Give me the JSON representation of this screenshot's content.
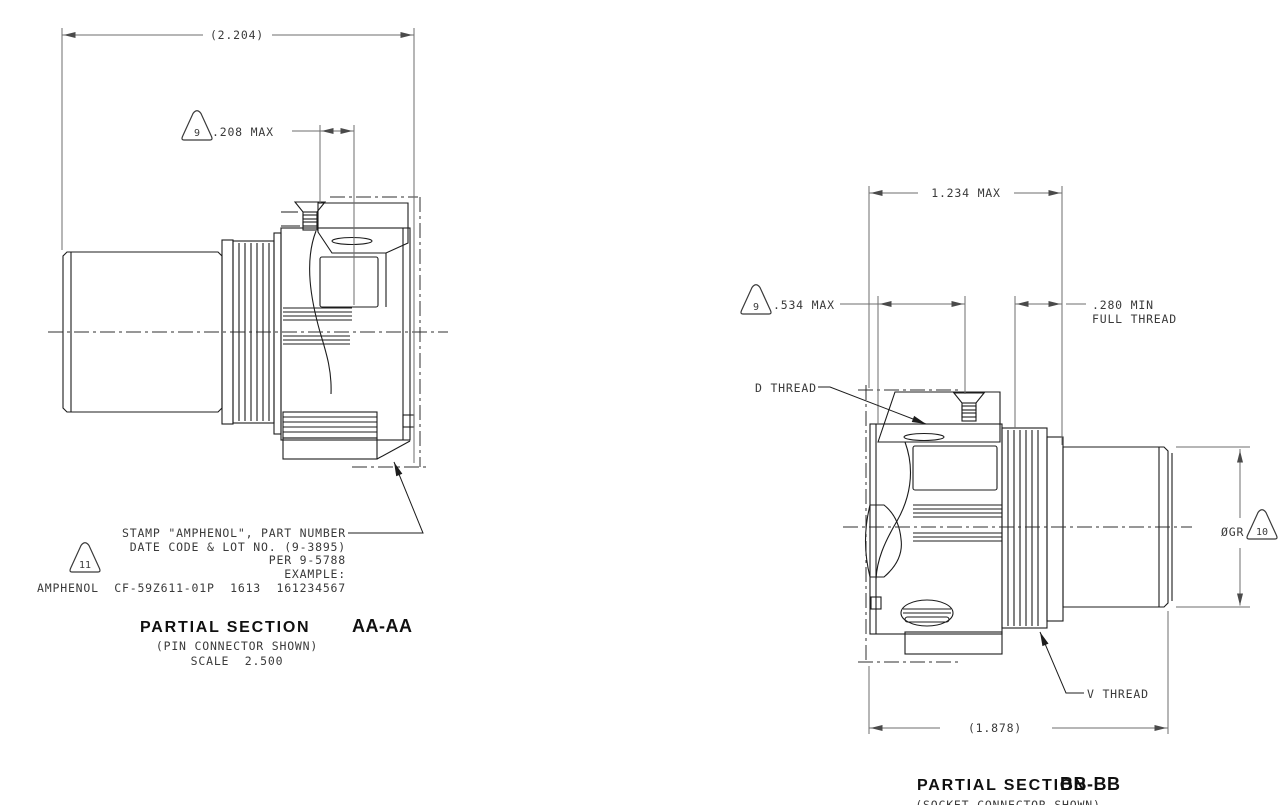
{
  "drawing": {
    "colors": {
      "part_line": "#1c1c1c",
      "dim_line": "#6e6e6e",
      "text": "#3a3a3a",
      "background": "#ffffff"
    },
    "aa": {
      "dim_overall": "(2.204)",
      "flag_208": "9",
      "dim_208": ".208 MAX",
      "note_flag": "11",
      "note_lines": [
        "STAMP \"AMPHENOL\", PART NUMBER",
        "DATE CODE & LOT NO. (9-3895)",
        "PER 9-5788",
        "EXAMPLE:",
        "AMPHENOL  CF-59Z611-01P  1613  161234567"
      ],
      "title": "PARTIAL SECTION",
      "section_id": "AA-AA",
      "subtitle": "(PIN CONNECTOR SHOWN)",
      "scale": "SCALE  2.500"
    },
    "bb": {
      "dim_width": "1.234 MAX",
      "flag_534": "9",
      "dim_534": ".534 MAX",
      "dim_280_line1": ".280 MIN",
      "dim_280_line2": "FULL THREAD",
      "label_d_thread": "D THREAD",
      "label_v_thread": "V THREAD",
      "dim_dia_prefix": "ØGR",
      "flag_dia": "10",
      "dim_overall": "(1.878)",
      "title": "PARTIAL SECTION",
      "section_id": "BB-BB",
      "subtitle": "(SOCKET CONNECTOR SHOWN)"
    }
  }
}
